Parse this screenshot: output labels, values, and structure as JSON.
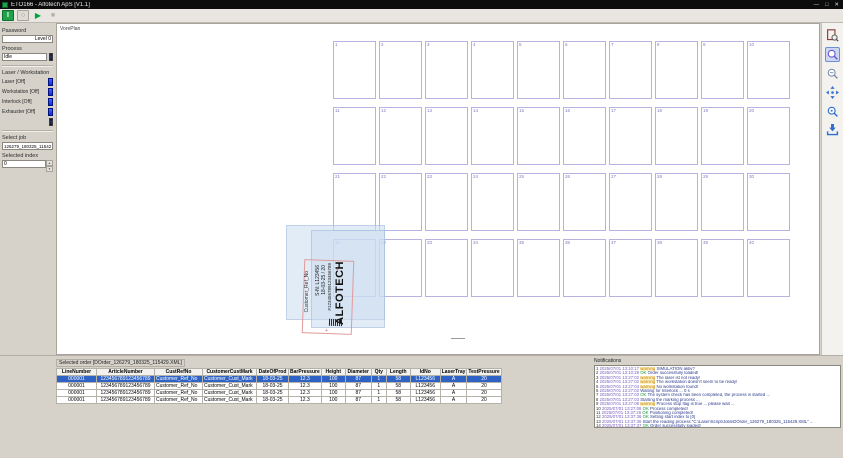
{
  "window": {
    "title": "ETO166 - Alfotech ApS [V1.1]"
  },
  "icons": {
    "power_on": "I",
    "power_off": "○",
    "play": "▶",
    "stop": "■",
    "minimize": "—",
    "maximize": "□",
    "close": "✕",
    "spin_up": "▲",
    "spin_down": "▼"
  },
  "left_panel": {
    "password_label": "Password",
    "password_value": "Level 0",
    "process_label": "Process",
    "process_value": "Idle",
    "section_label": "Laser / Workstation",
    "toggles": [
      {
        "label": "Laser [Off]"
      },
      {
        "label": "Workstation [Off]"
      },
      {
        "label": "Interlock [Off]"
      },
      {
        "label": "Exhauster [Off]"
      }
    ],
    "select_job_label": "Select job",
    "select_job_value": "126279_180325_115429",
    "selected_index_label": "Selected index",
    "selected_index_value": "0"
  },
  "canvas": {
    "view_label": "VorePlan",
    "grid": {
      "rows": 4,
      "cols": 10,
      "cell_numbers": [
        1,
        2,
        3,
        4,
        5,
        6,
        7,
        8,
        9,
        10,
        11,
        12,
        13,
        14,
        15,
        16,
        17,
        18,
        19,
        20,
        21,
        22,
        23,
        24,
        25,
        26,
        27,
        28,
        29,
        30,
        31,
        32,
        33,
        34,
        35,
        36,
        37,
        38,
        39,
        40
      ]
    },
    "label_preview": {
      "logo": "ALFOTECH",
      "article_line": "#123456789123456789",
      "date_line": "18-03-25 / 20",
      "serial_line": "S-N: L123456",
      "customer_line": "Customer_Ref_No"
    }
  },
  "bottom": {
    "selected_order_label": "Selected order [DOrder_126279_180325_115429.XML]",
    "table": {
      "columns": [
        "LineNumber",
        "ArticleNumber",
        "CustRefNo",
        "CustomerCustMark",
        "DateOfProd",
        "BarPressure",
        "Height",
        "Diameter",
        "Qty",
        "Length",
        "IdNo",
        "LaserTray",
        "TestPressure"
      ],
      "selected_row": 0,
      "rows": [
        [
          "000001",
          "123456789123456789",
          "Customer_Ref_No",
          "Customer_Cust_Mark",
          "18-03-25",
          "12.3",
          "100",
          "87",
          "1",
          "58",
          "L123456",
          "A",
          "20"
        ],
        [
          "000001",
          "123456789123456789",
          "Customer_Ref_No",
          "Customer_Cust_Mark",
          "18-03-25",
          "12.3",
          "100",
          "87",
          "1",
          "58",
          "L123456",
          "A",
          "20"
        ],
        [
          "000001",
          "123456789123456789",
          "Customer_Ref_No",
          "Customer_Cust_Mark",
          "18-03-25",
          "12.3",
          "100",
          "87",
          "1",
          "58",
          "L123456",
          "A",
          "20"
        ],
        [
          "000001",
          "123456789123456789",
          "Customer_Ref_No",
          "Customer_Cust_Mark",
          "18-03-25",
          "12.3",
          "100",
          "87",
          "1",
          "58",
          "L123456",
          "A",
          "20"
        ]
      ]
    },
    "notifications": {
      "title": "Notifications",
      "tag_labels": {
        "warning": "warning",
        "ok": "OK"
      },
      "items": [
        {
          "n": "1",
          "time": "2025/07/01 13:10:17",
          "tag": "warning",
          "msg": "SIMULATION aktiv?"
        },
        {
          "n": "2",
          "time": "2025/07/01 13:10:28",
          "tag": "ok",
          "msg": "Order successfully loaded!"
        },
        {
          "n": "3",
          "time": "2025/07/01 13:27:02",
          "tag": "warning",
          "msg": "The laser ist not ready!"
        },
        {
          "n": "4",
          "time": "2025/07/01 13:27:02",
          "tag": "warning",
          "msg": "The workstation doesn't seem to be ready!"
        },
        {
          "n": "5",
          "time": "2025/07/01 13:27:04",
          "tag": "warning",
          "msg": "No workstation found!"
        },
        {
          "n": "6",
          "time": "2025/07/01 13:27:02",
          "tag": "",
          "msg": "Waiting for Interlock ... 0 s"
        },
        {
          "n": "7",
          "time": "2025/07/01 13:27:03",
          "tag": "ok",
          "msg": "The system check has been completed, the process is started ..."
        },
        {
          "n": "8",
          "time": "2025/07/01 13:27:03",
          "tag": "",
          "msg": "Starting the marking process ..."
        },
        {
          "n": "9",
          "time": "2025/07/01 13:27:08",
          "tag": "warning",
          "msg": "Process stop flag is true ... please wait ..."
        },
        {
          "n": "10",
          "time": "2025/07/01 13:27:08",
          "tag": "ok",
          "msg": "Process completed!"
        },
        {
          "n": "11",
          "time": "2025/07/01 13:37:26",
          "tag": "ok",
          "msg": "Positioning completed!"
        },
        {
          "n": "12",
          "time": "2025/07/01 13:37:36",
          "tag": "ok",
          "msg": "Setting start index to [0]"
        },
        {
          "n": "13",
          "time": "2025/07/01 13:37:36",
          "tag": "",
          "msg": "Start the reading process \"C:\\Laser\\Script\\Jobs\\DOrder_126279_180325_115429.XML\" ..."
        },
        {
          "n": "14",
          "time": "2025/07/01 13:37:37",
          "tag": "ok",
          "msg": "Order successfully loaded!"
        }
      ]
    }
  },
  "colors": {
    "selection_blue": "#2e62c4",
    "led_blue": "#1428d8",
    "power_green": "#1fa24a",
    "grid_violet": "#b7b3e0",
    "warning_orange": "#c07b00",
    "ok_green": "#169a38"
  }
}
